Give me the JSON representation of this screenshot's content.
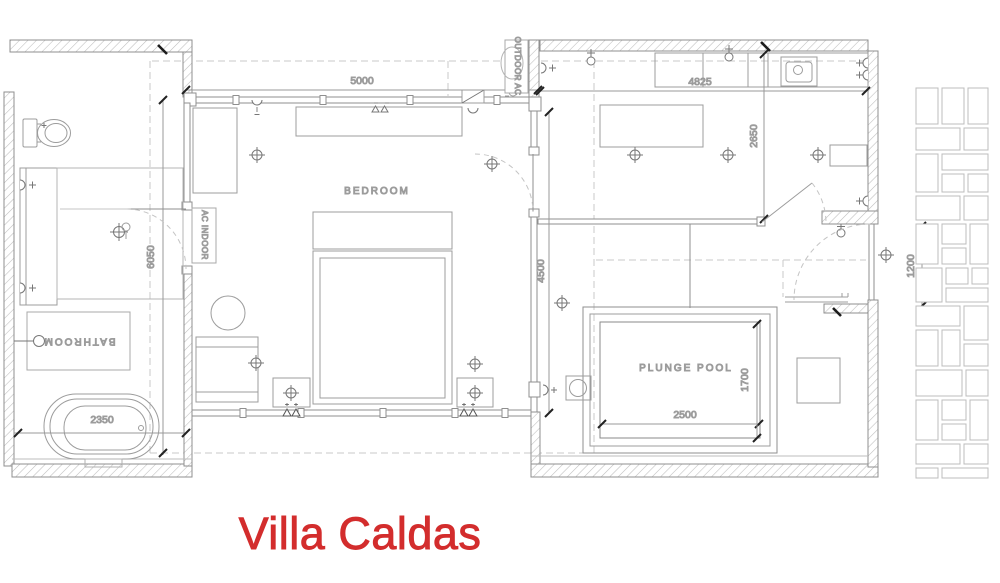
{
  "title": "Villa Caldas",
  "colors": {
    "title_red": "#d32d2d",
    "line_gray": "#8d8d8d"
  },
  "rooms": {
    "bedroom": "BEDROOM",
    "bathroom": "BATHROOM",
    "plunge_pool": "PLUNGE POOL",
    "ac_indoor": "AC INDOOR",
    "outdoor_ac": "OUTDOOR AC"
  },
  "dimensions": {
    "bedroom_width": "5000",
    "living_width": "4825",
    "bathroom_depth": "6050",
    "bedroom_depth": "4500",
    "living_depth": "2650",
    "pool_length": "2500",
    "pool_width": "1700",
    "bathtub_length": "2350",
    "walkway_width": "1200"
  }
}
